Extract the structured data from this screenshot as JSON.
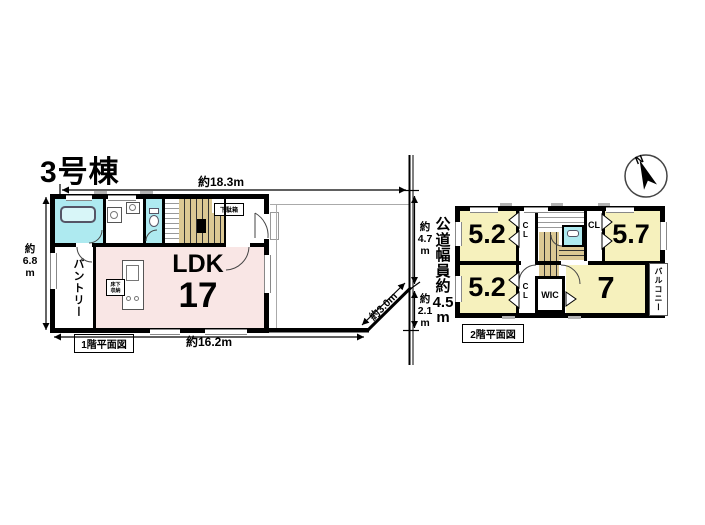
{
  "title": "3号棟",
  "floor1": {
    "caption": "1階平面図",
    "dims": {
      "top": "約18.3m",
      "left": "約\n6.8\nm",
      "bottom": "約16.2m"
    },
    "rooms": {
      "ldk_name": "LDK",
      "ldk_size": "17",
      "pantry": "パントリー",
      "underfloor_storage": "床下\n収納",
      "shoe_cabinet": "下駄箱"
    }
  },
  "road": {
    "width_label": "公\n道\n幅\n員\n約\n4.5\nm",
    "dim_upper": "約\n4.7\nm",
    "dim_lower": "約\n2.1\nm",
    "dim_diagonal": "約3.0m"
  },
  "floor2": {
    "caption": "2階平面図",
    "rooms": {
      "nw": "5.2",
      "ne": "5.7",
      "sw": "5.2",
      "se": "7",
      "cl_top_left": "CL",
      "cl_top_right": "CL",
      "cl_bottom": "CL",
      "wic": "WIC",
      "balcony": "バルコニー"
    }
  },
  "compass": {
    "north_label": "N"
  },
  "colors": {
    "ldk_pink": "#f9e6e5",
    "bedroom_yellow": "#f6f1bd",
    "water_cyan": "#aeeaf0",
    "stair_tan": "#dbc894",
    "wall_black": "#000000"
  }
}
